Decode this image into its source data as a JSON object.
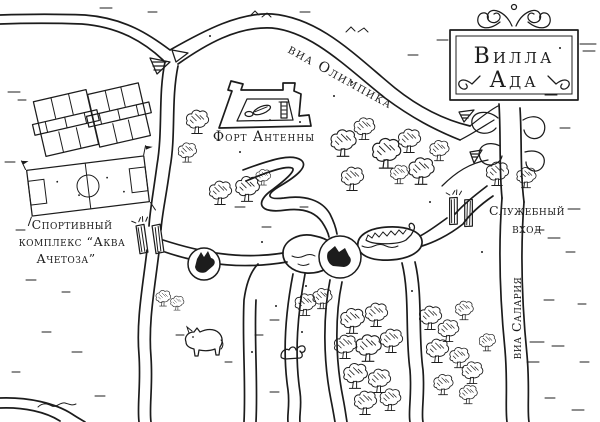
{
  "page": {
    "paper_color": "#ffffff",
    "ink_color": "#1c1c1c"
  },
  "sign": {
    "line1": "Вилла",
    "line2": "Ада"
  },
  "roads": {
    "via_olimpica_label": "виа Олимпика",
    "via_salaria_label": "виа Салария"
  },
  "landmarks": {
    "fort_label": "Форт Антенны",
    "sports_complex_line1": "Спортивный",
    "sports_complex_line2": "комплекс “Аква",
    "sports_complex_line3": "Ачетоза”",
    "service_entrance_line1": "Служебный",
    "service_entrance_line2": "вход"
  },
  "icons": {
    "sign_ornament": "scroll-ornament-icon",
    "fort": "fort-plan-icon",
    "tennis_court": "tennis-court-icon",
    "soccer_field": "soccer-field-icon",
    "gate": "park-gate-icon",
    "wolf_medallion": "wolf-head-medallion-icon",
    "lake_medallion": "animal-head-medallion-icon",
    "boat": "rowboat-icon",
    "rhino": "rhinoceros-icon",
    "squirrel": "squirrel-icon",
    "tree": "tree-icon",
    "lake": "lake-icon"
  }
}
